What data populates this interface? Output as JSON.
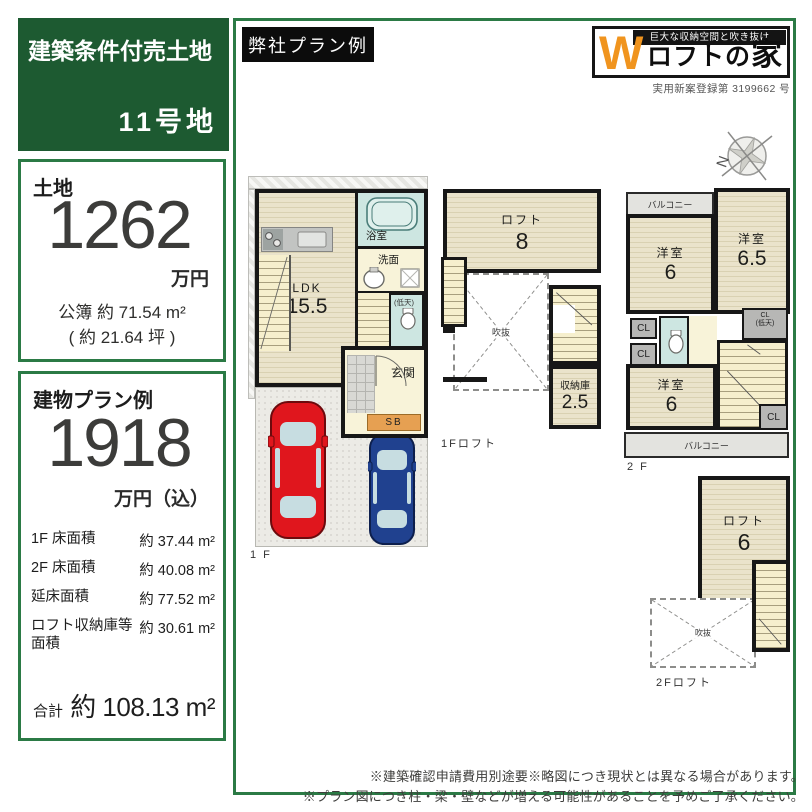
{
  "page": {
    "title_box": {
      "sale_type": "建築条件付売土地",
      "lot": "11号地"
    },
    "plan_tag": "弊社プラン例",
    "logo": {
      "tagline": "巨大な収納空間と吹き抜け",
      "w": "W",
      "name_head": "ロフトの",
      "name_tail": "家",
      "registration": "実用新案登録第 3199662 号"
    },
    "compass_n": "N"
  },
  "land": {
    "label": "土地",
    "price": "1262",
    "unit": "万円",
    "area_registered": "公簿 約 71.54 m²",
    "area_tsubo": "( 約 21.64 坪 )"
  },
  "building": {
    "label": "建物プラン例",
    "price": "1918",
    "unit": "万円（込）",
    "rows": [
      {
        "label": "1F 床面積",
        "value": "約 37.44 m²"
      },
      {
        "label": "2F 床面積",
        "value": "約 40.08 m²"
      },
      {
        "label": "延床面積",
        "value": "約 77.52 m²"
      },
      {
        "label": "ロフト収納庫等面積",
        "value": "約 30.61 m²"
      }
    ],
    "total_label": "合計",
    "total_value": "約 108.13 m²"
  },
  "plans": {
    "f1": {
      "caption": "1 F",
      "ldk": "LDK",
      "ldk_size": "15.5",
      "bath": "浴室",
      "wash": "洗面",
      "wc_note": "(低天)",
      "entrance": "玄関",
      "shoebox": "SB"
    },
    "f1loft": {
      "caption": "1Fロフト",
      "loft": "ロフト",
      "loft_size": "8",
      "void": "吹抜",
      "storage": "収納庫",
      "storage_size": "2.5"
    },
    "f2": {
      "caption": "2 F",
      "balcony": "バルコニー",
      "room1": "洋室",
      "room1_size": "6",
      "room2": "洋室",
      "room2_size": "6.5",
      "room3": "洋室",
      "room3_size": "6",
      "cl": "CL",
      "closet_line1": "CL",
      "closet_line2": "(低天)"
    },
    "f2loft": {
      "caption": "2Fロフト",
      "loft": "ロフト",
      "loft_size": "6",
      "void": "吹抜"
    }
  },
  "footer": {
    "line1": "※建築確認申請費用別途要※略図につき現状とは異なる場合があります。",
    "line2": "※プラン図につき柱・梁・壁などが増える可能性があることを予めご了承ください。"
  },
  "colors": {
    "brand_green": "#1d5a31",
    "frame_green": "#2b7a45",
    "accent_orange": "#f0941e",
    "car_red": "#e0161d",
    "car_blue": "#20418f",
    "floor_beige": "#e9e2ca",
    "bath_teal": "#cde6e1",
    "hall_yellow": "#f8f3d9"
  }
}
